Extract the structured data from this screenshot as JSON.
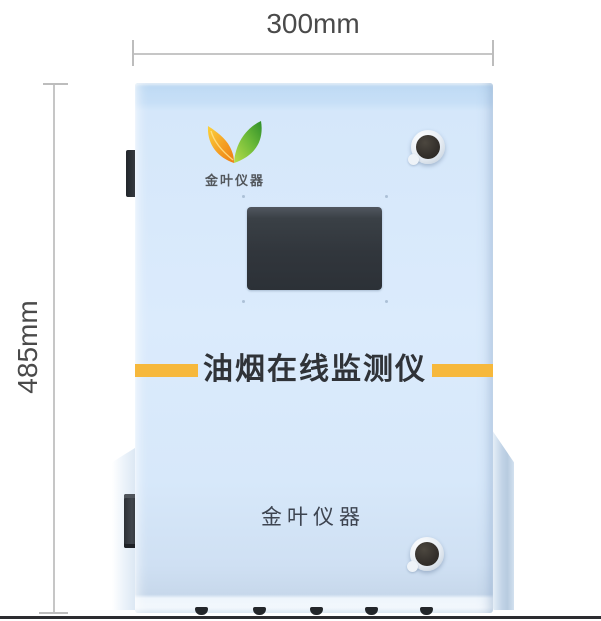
{
  "annotations": {
    "width_label": "300mm",
    "height_label": "485mm"
  },
  "device": {
    "logo_caption": "金叶仪器",
    "banner_title": "油烟在线监测仪",
    "brand_text": "金叶仪器"
  },
  "icons": {
    "logo": "dual-leaf-logo",
    "knobs": "cam-lock-knob"
  },
  "colors": {
    "cabinet_blue": "#d7e8fa",
    "accent_yellow": "#f6b83c",
    "screen_dark": "#31363d",
    "leaf_orange": "#ef8b1d",
    "leaf_green": "#3f9c31",
    "dimension_text": "#4a4a4a",
    "ground_line": "#2c2c30"
  }
}
